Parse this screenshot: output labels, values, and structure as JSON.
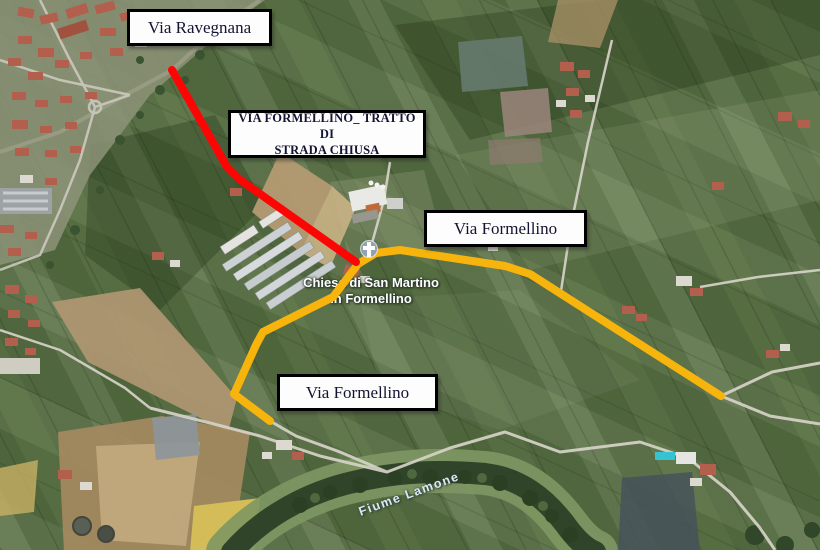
{
  "map": {
    "annotation_labels": {
      "via_ravegnana": "Via Ravegnana",
      "strada_chiusa_line1": "VIA FORMELLINO_ TRATTO DI",
      "strada_chiusa_line2": "STRADA CHIUSA",
      "via_formellino_upper": "Via Formellino",
      "via_formellino_lower": "Via Formellino"
    },
    "place_labels": {
      "church_line1": "Chiesa di San Martino",
      "church_line2": "in Formellino",
      "river": "Fiume Lamone"
    },
    "routes": {
      "closed_segment_color": "#fe0505",
      "open_route_color": "#f6b40c"
    },
    "icons": {
      "church_marker": "cross-shape"
    }
  }
}
